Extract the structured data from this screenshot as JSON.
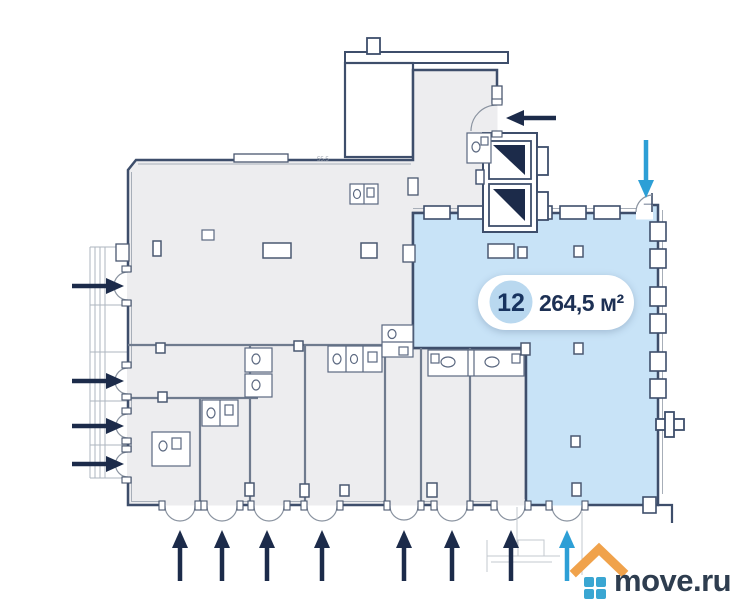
{
  "floor_plan": {
    "unit_badge": {
      "number": "12",
      "area_label": "264,5 м²"
    },
    "dimension_label": "55.5",
    "entrances": {
      "left_dark_arrows": 4,
      "bottom_dark_arrows": 7,
      "upper_right_dark_arrows": 1,
      "accent_arrows": 2
    },
    "colors": {
      "highlighted_unit_fill": "#c8e3f7",
      "floor_fill": "#ededef",
      "wall_stroke": "#3e4e6b",
      "partition_stroke": "#6f7b8e",
      "arrow_dark": "#1c2b4a",
      "arrow_accent": "#2d9fd6",
      "badge_circle_fill": "#b9d8ef",
      "badge_text": "#17335f"
    },
    "icons": {
      "dark_arrow": "entrance-arrow",
      "accent_arrow": "highlighted-entrance-arrow",
      "elevator": "elevator-shaft",
      "door_arc": "door-swing",
      "wc": "wc-fixtures"
    }
  },
  "watermark": {
    "logo_text": "move.ru",
    "roof_color": "#f0a24b",
    "squares_color": "#3aa6d2",
    "text_color": "#2e3d4f"
  }
}
